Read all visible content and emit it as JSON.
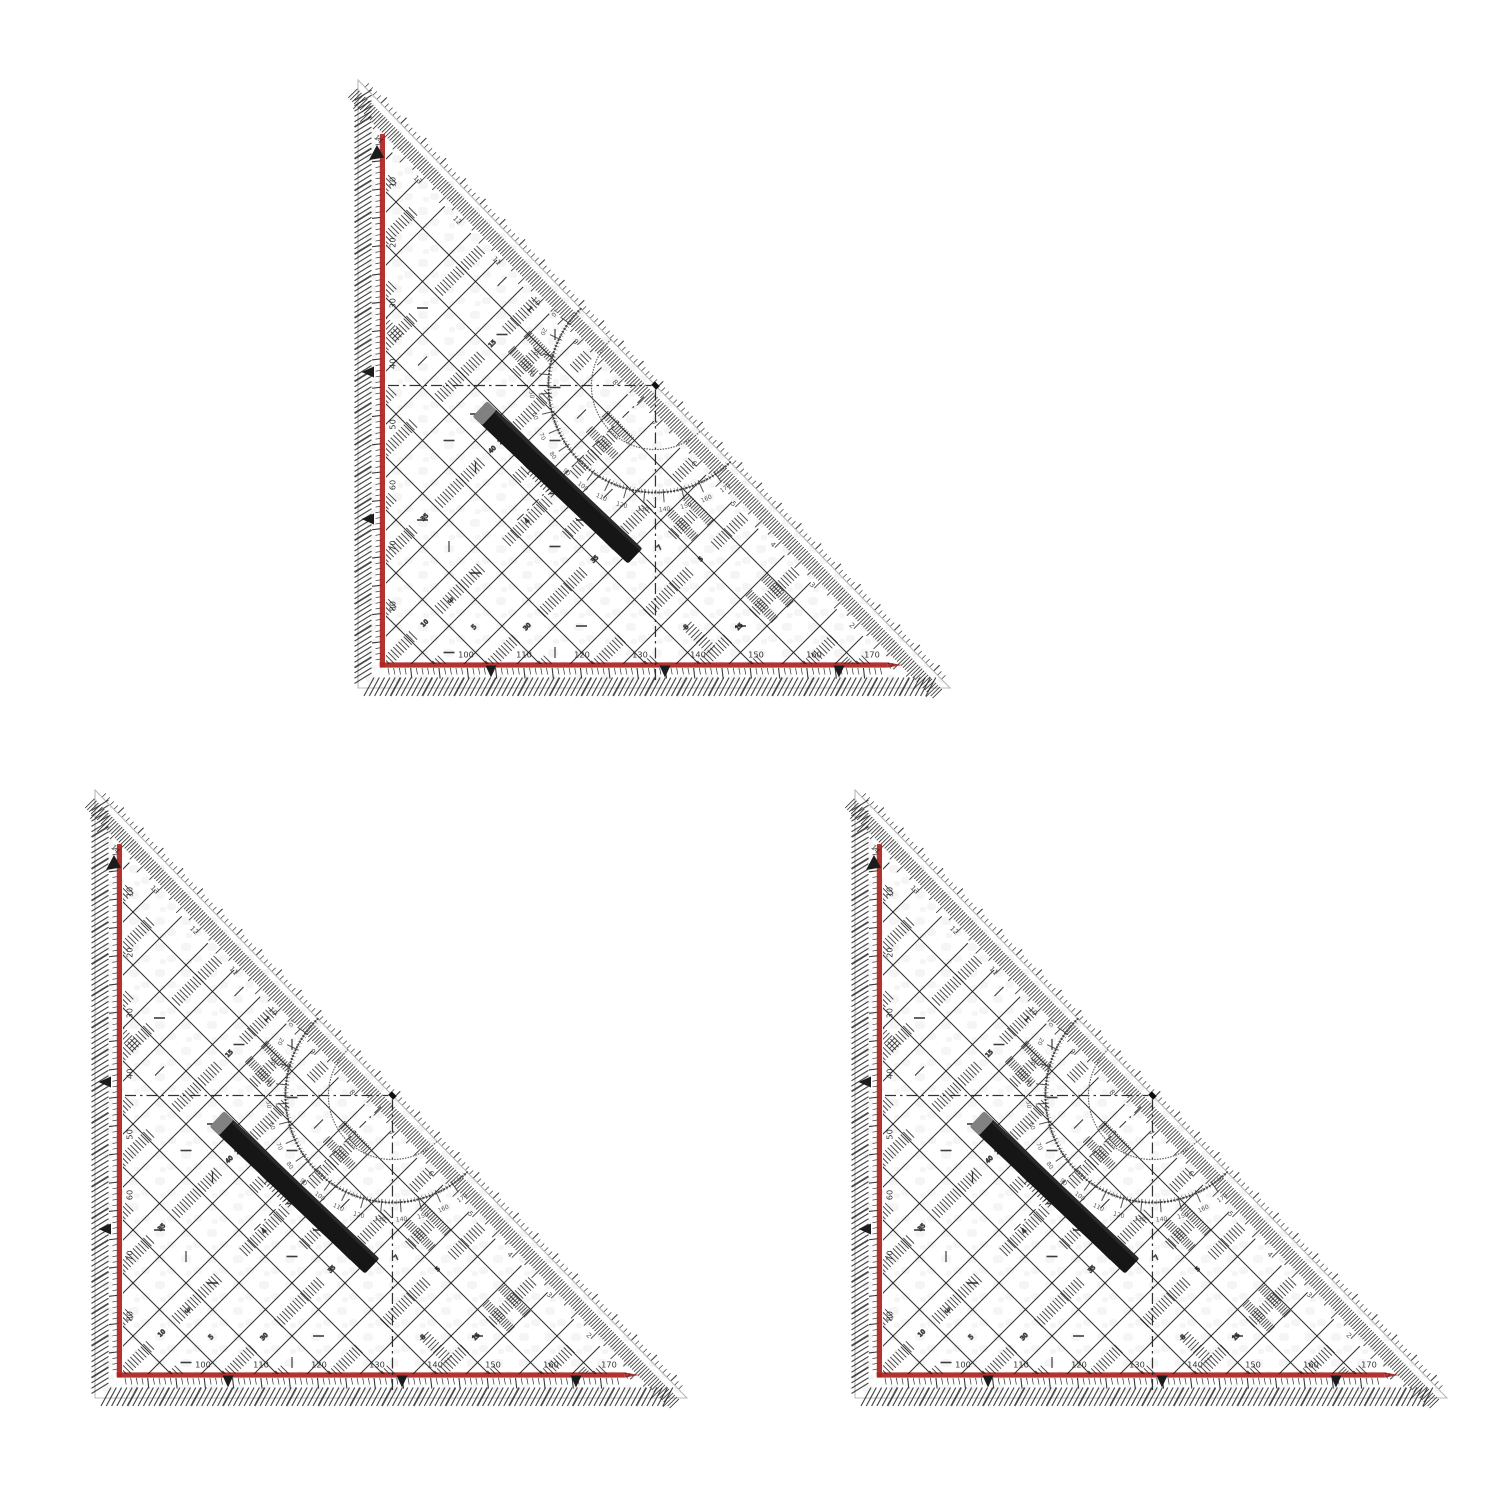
{
  "scene": {
    "background": "#ffffff",
    "object_count": 3
  },
  "colors": {
    "red": "#ad2420",
    "ink": "#1c1c1c",
    "ink_soft": "#3a3a3a",
    "dot": "#4a4a4a",
    "plastic_edge": "#b9b9b9",
    "mottle": "#ededed",
    "handle": "#161616",
    "handle_cap": "#8d8d8d"
  },
  "scales": {
    "bottom_numbers": [
      "100",
      "110",
      "120",
      "130",
      "140",
      "150",
      "160",
      "170"
    ],
    "left_numbers": [
      "10",
      "20",
      "30",
      "40",
      "50",
      "60",
      "70",
      "80"
    ],
    "hypotenuse_numbers": [
      "14",
      "13",
      "12",
      "11",
      "10",
      "9",
      "8",
      "7",
      "6",
      "5",
      "4",
      "3",
      "2",
      "1"
    ],
    "protractor_numbers": [
      "10",
      "20",
      "30",
      "40",
      "50",
      "60",
      "70",
      "80",
      "90",
      "100",
      "110",
      "120",
      "130",
      "140",
      "150",
      "160",
      "170"
    ],
    "band_digits": [
      "5",
      "10",
      "15",
      "20",
      "25",
      "30",
      "35",
      "40"
    ],
    "cell_digits": [
      "1",
      "2",
      "3",
      "4",
      "5",
      "7",
      "8"
    ]
  },
  "triangles": [
    {
      "id": "drafting-triangle-top",
      "x": 338,
      "y": 74
    },
    {
      "id": "drafting-triangle-bottom-left",
      "x": 75,
      "y": 784
    },
    {
      "id": "drafting-triangle-bottom-right",
      "x": 835,
      "y": 784
    }
  ]
}
